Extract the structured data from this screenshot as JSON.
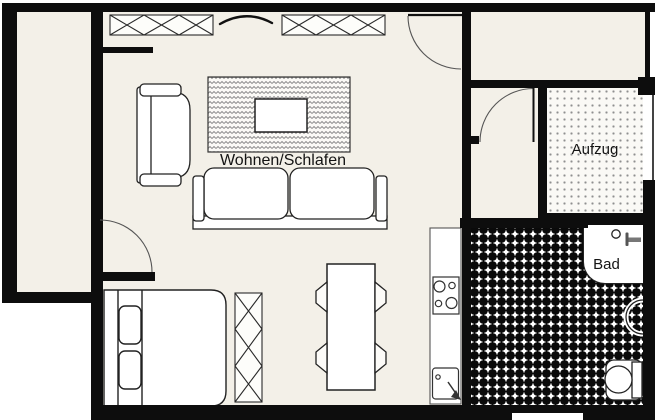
{
  "plan": {
    "type": "apartment-floor-plan",
    "rooms": {
      "living": {
        "label": "Wohnen/Schlafen"
      },
      "elevator": {
        "label": "Aufzug"
      },
      "bathroom": {
        "label": "Bad"
      }
    },
    "furniture": [
      "sofa",
      "armchair",
      "coffee-table",
      "rug",
      "double-bed",
      "wardrobe",
      "dining-table",
      "chair",
      "kitchen-counter",
      "stove",
      "kitchen-sink",
      "toilet",
      "wash-basin",
      "radiator-window",
      "door-swing",
      "balcony"
    ],
    "colors": {
      "wall": "#0d0d0d",
      "floor": "#f3f0e8",
      "furniture_fill": "#ffffff",
      "outline": "#222222",
      "pattern_gray": "#8a8a8a",
      "label_text": "#141414"
    }
  }
}
